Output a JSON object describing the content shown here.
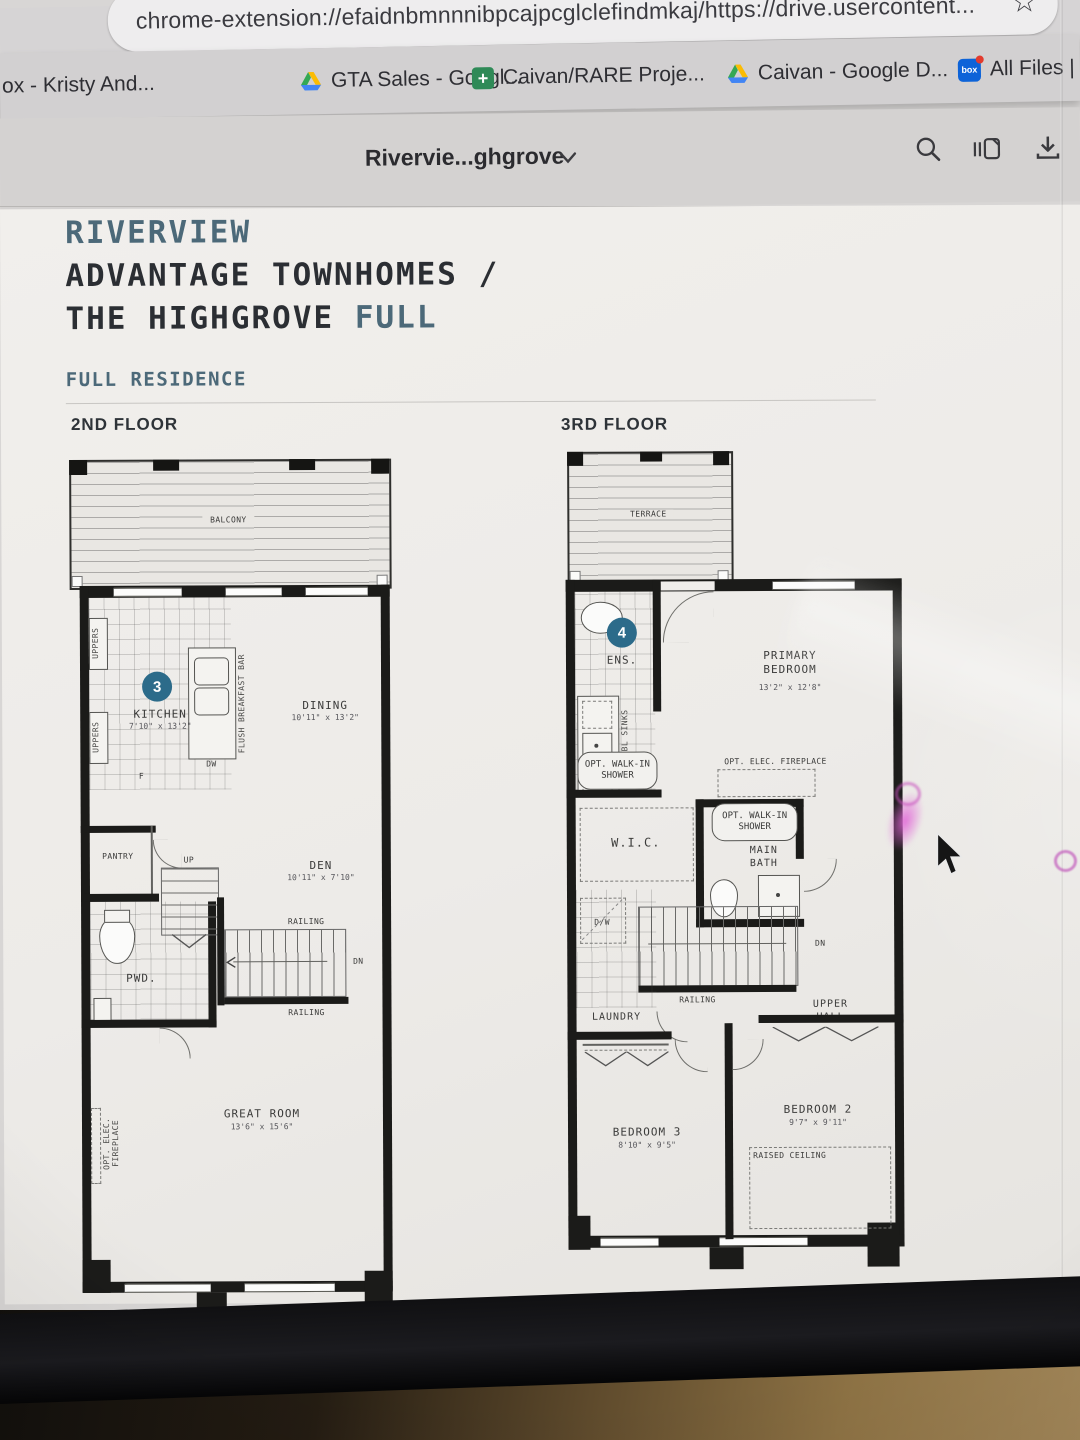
{
  "browser": {
    "url": "chrome-extension://efaidnbmnnnibpcajpcglclefindmkaj/https://drive.usercontent...",
    "star_icon": "☆",
    "bookmarks": [
      {
        "label": "ox - Kristy And...",
        "icon": "none"
      },
      {
        "label": "GTA Sales - Googl...",
        "icon": "drive-icon"
      },
      {
        "label": "Caivan/RARE Proje...",
        "icon": "plus-icon"
      },
      {
        "label": "Caivan - Google D...",
        "icon": "drive-icon"
      },
      {
        "label": "All Files | ",
        "icon": "box-icon"
      }
    ]
  },
  "viewer": {
    "doc_title": "Rivervie...ghgrove",
    "box_logo_text": "box"
  },
  "doc": {
    "title_accent": "RIVERVIEW",
    "title_line2": "ADVANTAGE TOWNHOMES /",
    "title_line3": "THE HIGHGROVE",
    "title_line3_accent": "FULL",
    "subtitle": "FULL RESIDENCE",
    "floor2_label": "2ND FLOOR",
    "floor3_label": "3RD FLOOR"
  },
  "plan2": {
    "balcony": "BALCONY",
    "uppers_top": "UPPERS",
    "uppers_bottom": "UPPERS",
    "badge": "3",
    "kitchen_name": "KITCHEN",
    "kitchen_dims": "7'10\" x 13'2\"",
    "breakfast_bar": "FLUSH BREAKFAST BAR",
    "dw": "DW",
    "f": "F",
    "dining_name": "DINING",
    "dining_dims": "10'11\" x 13'2\"",
    "pantry": "PANTRY",
    "pwd": "PWD.",
    "up": "UP",
    "dn": "DN",
    "railing_top": "RAILING",
    "railing_bottom": "RAILING",
    "den_name": "DEN",
    "den_dims": "10'11\" x 7'10\"",
    "great_room_name": "GREAT ROOM",
    "great_room_dims": "13'6\" x 15'6\"",
    "fireplace": "OPT. ELEC. FIREPLACE"
  },
  "plan3": {
    "terrace": "TERRACE",
    "badge": "4",
    "ens": "ENS.",
    "dbl_sinks": "OPT. DBL SINKS",
    "walkin_shower_ens": "OPT. WALK-IN SHOWER",
    "primary_name": "PRIMARY BEDROOM",
    "primary_dims": "13'2\" x 12'8\"",
    "fireplace": "OPT. ELEC. FIREPLACE",
    "walkin_shower_bath": "OPT. WALK-IN SHOWER",
    "wic": "W.I.C.",
    "main_bath": "MAIN BATH",
    "dw": "D/W",
    "laundry": "LAUNDRY",
    "railing": "RAILING",
    "upper_hall": "UPPER HALL",
    "dn": "DN",
    "bedroom3_name": "BEDROOM 3",
    "bedroom3_dims": "8'10\" x 9'5\"",
    "bedroom2_name": "BEDROOM 2",
    "bedroom2_dims": "9'7\" x 9'11\"",
    "raised_ceiling": "RAISED CEILING"
  },
  "colors": {
    "accent": "#4c6979",
    "badge": "#2c6b8a",
    "wall": "#1b1b19"
  }
}
